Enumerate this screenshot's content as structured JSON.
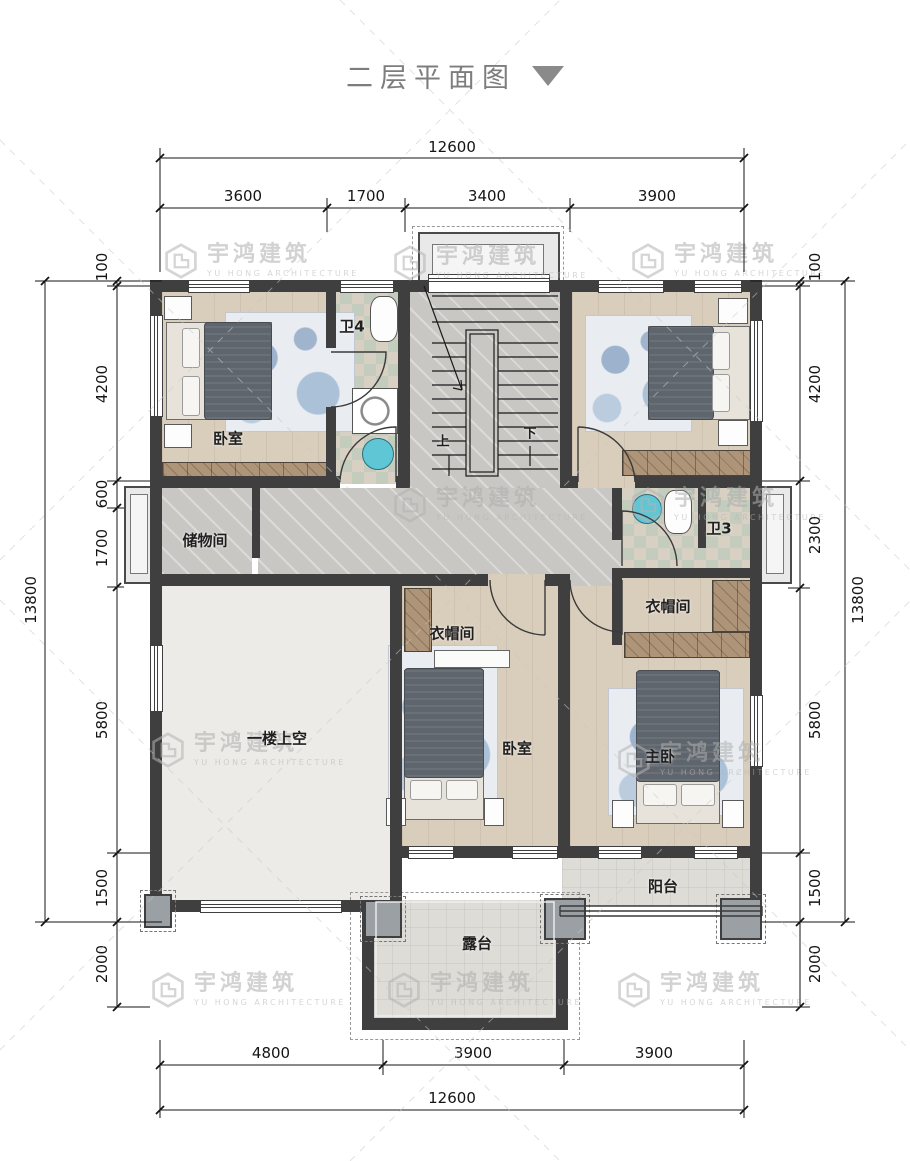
{
  "title": {
    "text": "二层平面图"
  },
  "watermark": {
    "cn": "宇鸿建筑",
    "en": "YU HONG ARCHITECTURE"
  },
  "stairs": {
    "up": "上",
    "down": "下"
  },
  "rooms": {
    "bedroom_top_left": "卧室",
    "bath4": "卫4",
    "storage": "储物间",
    "void_above_first_floor": "一楼上空",
    "cloakroom_middle": "衣帽间",
    "cloakroom_master": "衣帽间",
    "bedroom_middle": "卧室",
    "master_bedroom": "主卧",
    "bath3": "卫3",
    "balcony": "阳台",
    "terrace": "露台"
  },
  "dimensions": {
    "top": {
      "total": "12600",
      "segments": [
        "3600",
        "1700",
        "3400",
        "3900"
      ]
    },
    "bottom": {
      "total": "12600",
      "segments": [
        "4800",
        "3900",
        "3900"
      ]
    },
    "left": {
      "total": "13800",
      "segments": [
        "100",
        "4200",
        "600",
        "1700",
        "5800",
        "1500",
        "2000"
      ]
    },
    "right": {
      "total": "13800",
      "segments": [
        "100",
        "4200",
        "2300",
        "5800",
        "1500",
        "2000"
      ]
    }
  }
}
